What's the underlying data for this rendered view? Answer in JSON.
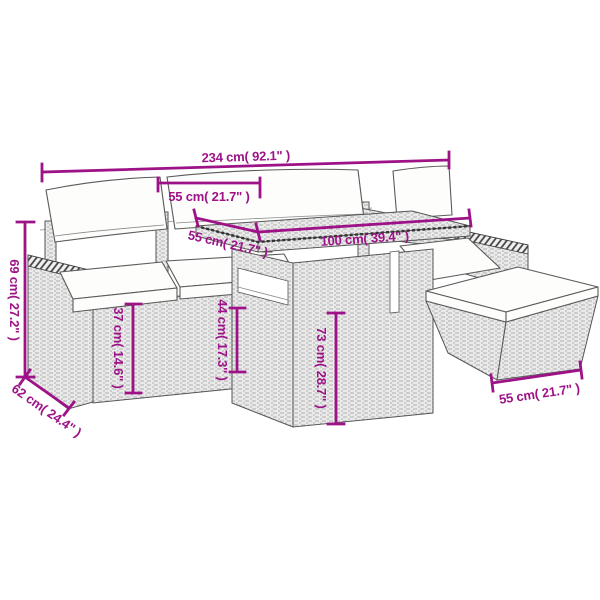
{
  "meta": {
    "title": "Rattan garden lounge set with table and ottoman - dimension diagram",
    "canvas_width": 600,
    "canvas_height": 600
  },
  "colors": {
    "dimension_accent": "#9e1288",
    "line_art_outline": "#565656",
    "rattan_fill": "#eaeaea",
    "cushion_fill": "#fdfdfc",
    "background": "#ffffff"
  },
  "dimensions": {
    "total_width": "234 cm( 92.1\" )",
    "seat_width": "55 cm( 21.7\" )",
    "table_depth": "55 cm( 21.7\" )",
    "table_width": "100 cm( 39.4\" )",
    "back_height": "69 cm( 27.2\" )",
    "seat_height": "37 cm( 14.6\" )",
    "armrest_height": "44 cm( 17.3\" )",
    "table_height": "73 cm( 28.7\" )",
    "seat_depth": "62 cm( 24.4\" )",
    "ottoman_width": "55 cm( 21.7\" )"
  }
}
